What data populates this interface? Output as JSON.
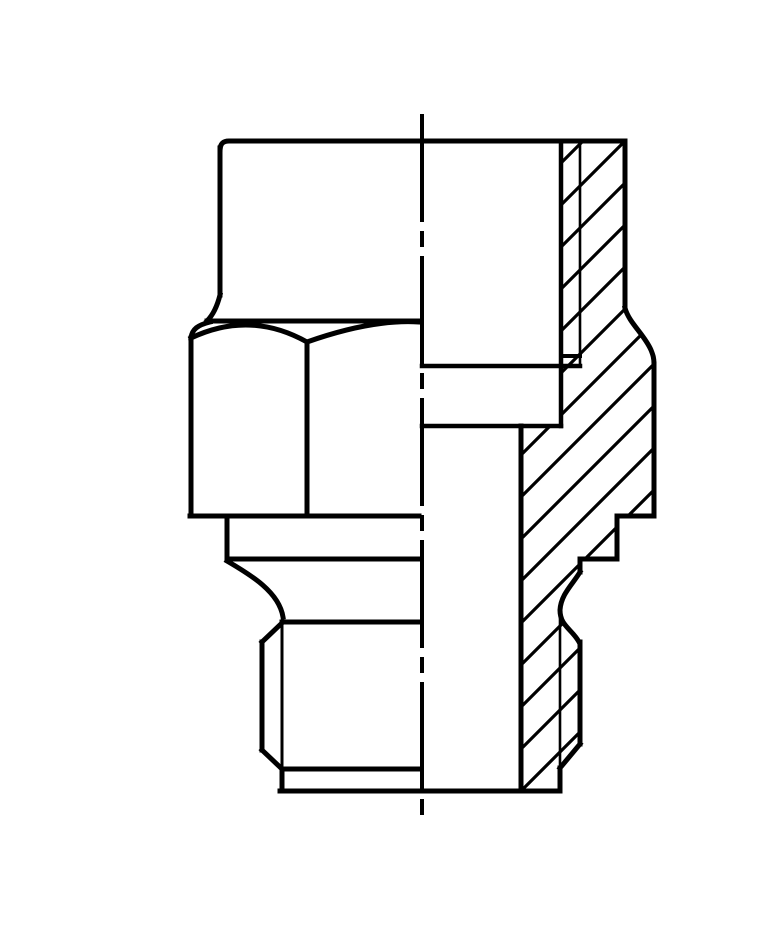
{
  "canvas": {
    "width": 760,
    "height": 950,
    "background": "#ffffff",
    "ink": "#000000"
  },
  "drawing": {
    "kind": "technical-drawing",
    "subject": "threaded-union-fitting-half-view-half-section",
    "centerline": {
      "d": "M382,98 L382,806",
      "width": 4,
      "dash": [
        108,
        9,
        16,
        9
      ]
    },
    "hatch": {
      "clip_path": "M521,125 L585,125 L585,292 C589,307 604,318 611,334 C613,339 614,342 614,348 L614,500 L577,500 L577,543 L540,543 L540,556 C533,568 521,578 520,594 C520,610 532,613 539,626 L540,626 L540,728 L520,752 L520,775 L481,775 L481,410 L521,410 Z",
      "angle": "45-up-right",
      "c_start": 668,
      "c_end": 1298,
      "spacing": 42,
      "width": 3.2
    },
    "outlines": [
      {
        "id": "top-face",
        "d": "M180,134 Q180,125 189,125 L585,125",
        "w": 5
      },
      {
        "id": "upper-body-left-edge",
        "d": "M180,132 L180,279",
        "w": 5
      },
      {
        "id": "upper-left-flare",
        "d": "M180,279 C177,291 173,299 167,305",
        "w": 5
      },
      {
        "id": "hex-top-plane-line",
        "d": "M167,305 L379,305",
        "w": 5
      },
      {
        "id": "hex-left-chamfer-arc",
        "d": "M170,306 C158,309 152,313 151,322",
        "w": 5
      },
      {
        "id": "hex-left-edge",
        "d": "M151,322 L151,500",
        "w": 5
      },
      {
        "id": "hex-facet-arc-left",
        "d": "M151,322 Q210,294 267,326",
        "w": 5
      },
      {
        "id": "hex-facet-arc-right",
        "d": "M267,326 Q332,303 379,306",
        "w": 5
      },
      {
        "id": "hex-facet-divider",
        "d": "M267,327 L267,500",
        "w": 5
      },
      {
        "id": "hex-bottom-line",
        "d": "M150,500 L379,500",
        "w": 5
      },
      {
        "id": "collar-left-edge",
        "d": "M187,500 L187,543",
        "w": 5
      },
      {
        "id": "collar-bottom-line",
        "d": "M187,543 L379,543",
        "w": 5
      },
      {
        "id": "left-neck-curve",
        "d": "M187,545 C211,559 239,576 243,601",
        "w": 5
      },
      {
        "id": "thread-start-line",
        "d": "M242,606 L379,606",
        "w": 5
      },
      {
        "id": "left-thread-lead-chamfer",
        "d": "M243,606 L222,626",
        "w": 5
      },
      {
        "id": "left-stem-outline",
        "d": "M222,626 L222,734",
        "w": 5
      },
      {
        "id": "left-end-chamfer",
        "d": "M222,734 L242,753",
        "w": 5
      },
      {
        "id": "chamfer-circle-line",
        "d": "M242,753 L379,753",
        "w": 5
      },
      {
        "id": "left-tip-edge",
        "d": "M242,753 L242,775",
        "w": 5
      },
      {
        "id": "bottom-end-face",
        "d": "M240,775 L520,775",
        "w": 5
      },
      {
        "id": "outer-wall-upper",
        "d": "M585,125 L585,292",
        "w": 5
      },
      {
        "id": "outer-wall-flare",
        "d": "M585,292 C589,307 604,318 611,334 C613,339 614,342 614,348",
        "w": 5
      },
      {
        "id": "outer-wall-mid",
        "d": "M614,348 L614,500",
        "w": 5
      },
      {
        "id": "section-step1-h",
        "d": "M614,500 L577,500",
        "w": 5
      },
      {
        "id": "section-step1-v",
        "d": "M577,500 L577,543",
        "w": 5
      },
      {
        "id": "section-step2-h",
        "d": "M577,543 L540,543",
        "w": 5
      },
      {
        "id": "section-step2-v",
        "d": "M540,543 L540,556",
        "w": 5
      },
      {
        "id": "right-groove-curve",
        "d": "M540,556 C533,568 521,578 520,594 C520,610 532,613 539,626",
        "w": 5
      },
      {
        "id": "right-stem-major",
        "d": "M540,626 L540,728",
        "w": 5
      },
      {
        "id": "right-end-chamfer",
        "d": "M540,728 L520,752",
        "w": 5
      },
      {
        "id": "right-tip-edge",
        "d": "M520,752 L520,775",
        "w": 5
      },
      {
        "id": "bore-wall-upper",
        "d": "M521,125 L521,410",
        "w": 4.5
      },
      {
        "id": "bore-shoulder-line",
        "d": "M382,350 L540,350",
        "w": 4.5
      },
      {
        "id": "thread-end-line",
        "d": "M521,340 L540,340",
        "w": 4
      },
      {
        "id": "bore-step-line",
        "d": "M382,410 L521,410",
        "w": 4.5
      },
      {
        "id": "bore-wall-lower",
        "d": "M481,410 L481,775",
        "w": 5
      }
    ],
    "thin_lines": [
      {
        "id": "internal-thread-major",
        "d": "M540,125 L540,348",
        "w": 2.6
      },
      {
        "id": "external-thread-minor-right",
        "d": "M520,598 L520,752",
        "w": 2.6
      },
      {
        "id": "external-thread-minor-left",
        "d": "M242,606 L242,753",
        "w": 3
      }
    ]
  }
}
